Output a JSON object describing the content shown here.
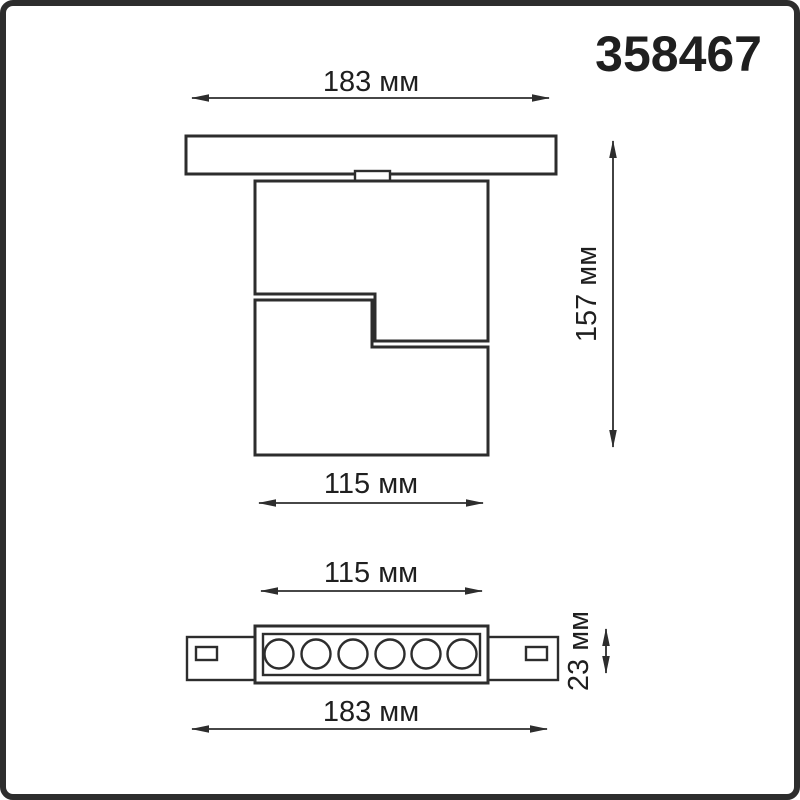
{
  "article": "358467",
  "colors": {
    "line": "#2d2d2d",
    "text": "#1f1f1f",
    "background": "#ffffff",
    "border": "#2d2d2d"
  },
  "dimensions": {
    "top_width_label": "183 мм",
    "side_height_label": "157 мм",
    "body_width_label": "115 мм",
    "front_body_width_label": "115 мм",
    "front_height_label": "23 мм",
    "front_width_label": "183 мм"
  }
}
